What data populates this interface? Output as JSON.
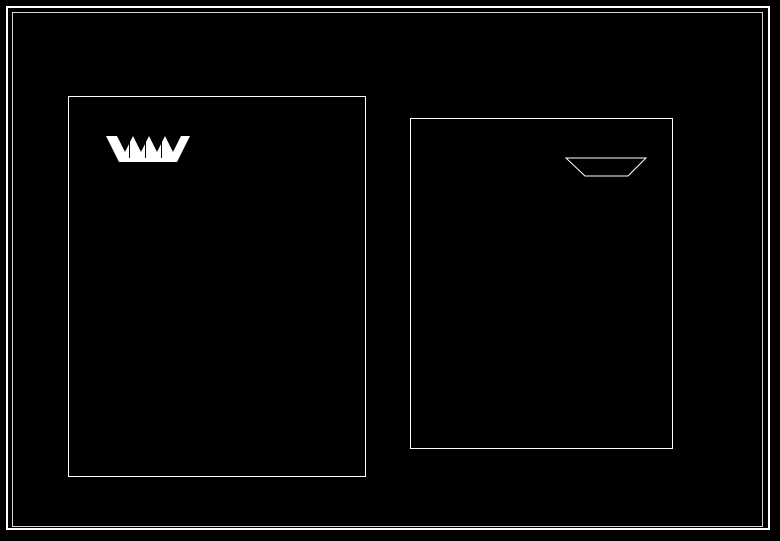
{
  "scale_note": "1:40",
  "watermark": "802",
  "colors": {
    "background": "#000000",
    "line": "#ffffff"
  },
  "drawings": {
    "d17": {
      "label": "柱樣式17",
      "callouts": [
        "Ø50",
        "GRC-1",
        "5×50",
        "30×30",
        "60×20",
        "10×10",
        "250×250",
        "2×Ø8",
        "Ø6@200",
        "100×100",
        "40×5",
        "C20"
      ]
    },
    "d18": {
      "label": "柱樣式18",
      "callouts": [
        "60×5",
        "Ø6@200",
        "25×25",
        "10×10",
        "8×8",
        "5×5",
        "C20",
        "100",
        "MU10"
      ]
    },
    "d14": {
      "label": "柱樣式14",
      "callouts": [
        "30×5",
        "Ø8",
        "150×150",
        "100×100",
        "60×60",
        "25×25",
        "C15"
      ]
    },
    "d15": {
      "label": "柱樣式15",
      "callouts": [
        "40×5",
        "30×5",
        "20×5",
        "15×5",
        "10×5",
        "200×200",
        "Ø6",
        "100×100",
        "C15"
      ]
    },
    "d16": {
      "label": "柱樣式16",
      "callouts": [
        "50×5",
        "40×5",
        "30×5",
        "20×5",
        "Ø8@200",
        "150×150",
        "MU10"
      ]
    }
  }
}
